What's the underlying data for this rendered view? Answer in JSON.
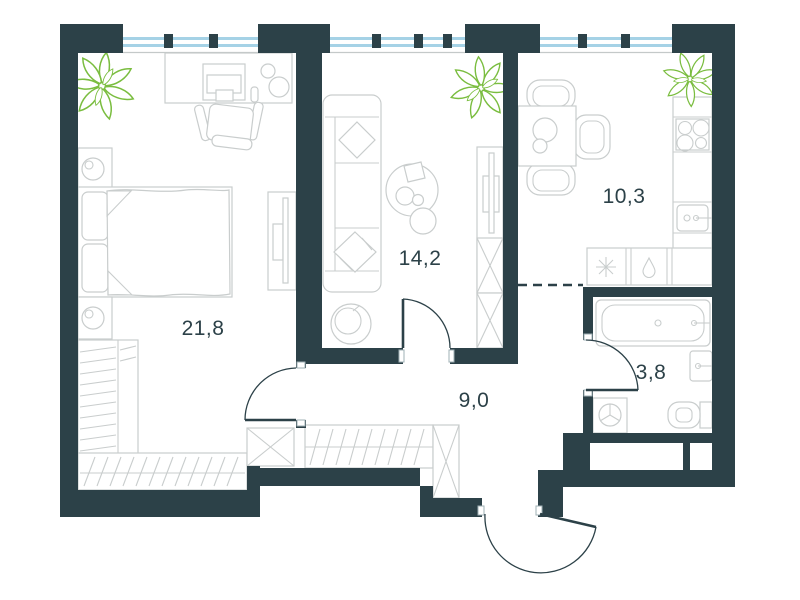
{
  "plan": {
    "type": "apartment-floor-plan",
    "rooms": [
      {
        "name": "bedroom",
        "area_label": "21,8"
      },
      {
        "name": "living-room",
        "area_label": "14,2"
      },
      {
        "name": "kitchen-dining",
        "area_label": "10,3"
      },
      {
        "name": "hallway",
        "area_label": "9,0"
      },
      {
        "name": "bathroom",
        "area_label": "3,8"
      }
    ],
    "fixtures": {
      "bedroom": [
        "plant-icon",
        "desk",
        "monitor",
        "desk-chair",
        "nightstand-lamp-icon",
        "double-bed",
        "tv-panel",
        "shelving-rack",
        "wardrobe-hangers-icon",
        "storage-cabinet-x-icon"
      ],
      "living_room": [
        "sofa",
        "pillow-icons",
        "coffee-table",
        "pouf",
        "tv-stand",
        "storage-cabinet-x-icon",
        "plant-icon"
      ],
      "kitchen": [
        "dining-table",
        "chairs",
        "counter",
        "cooktop-burners-icon",
        "sink-icon",
        "fridge-snowflake-icon",
        "dishwasher-drop-icon",
        "plant-icon"
      ],
      "hallway": [
        "wardrobe-hangers-icon",
        "storage-cabinet-x-icon",
        "entrance-door"
      ],
      "bathroom": [
        "bathtub",
        "washbasin",
        "toilet-icon",
        "washing-machine-icon"
      ]
    },
    "colors": {
      "wall": "#2C4148",
      "furniture_stroke": "#C9CDCD",
      "window_glass": "#A5D2E6",
      "plant": "#7ABD3F",
      "label_text": "#2C4148",
      "sill": "#C4C9C9",
      "floor": "#FFFFFF"
    }
  }
}
